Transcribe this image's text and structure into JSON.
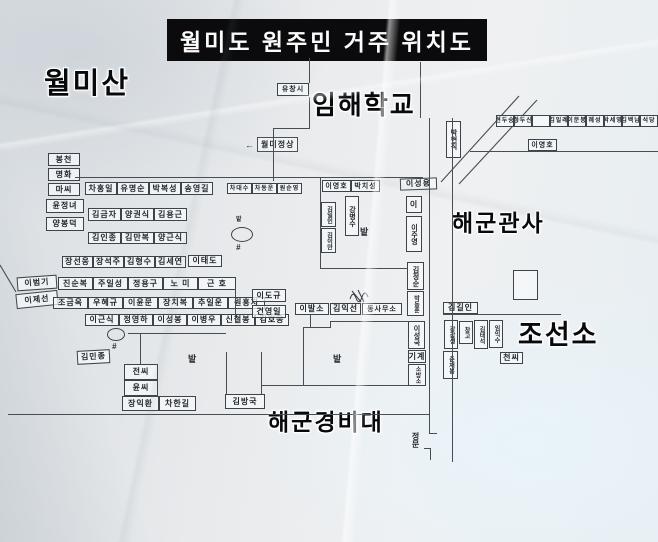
{
  "title": "월미도 원주민 거주 위치도",
  "area_labels": [
    {
      "id": "wolmisan",
      "text": "월미산",
      "x": 44,
      "y": 70,
      "fs": 29
    },
    {
      "id": "imhae-school",
      "text": "임해학교",
      "x": 312,
      "y": 92,
      "fs": 26
    },
    {
      "id": "navy-quarters",
      "text": "해군관사",
      "x": 452,
      "y": 212,
      "fs": 23
    },
    {
      "id": "shipyard",
      "text": "조선소",
      "x": 518,
      "y": 322,
      "fs": 27
    },
    {
      "id": "navy-guard",
      "text": "해군경비대",
      "x": 268,
      "y": 411,
      "fs": 23
    }
  ],
  "summit": {
    "arrow": "←",
    "text": "월미정상"
  },
  "gate": {
    "text": "정문"
  },
  "field_labels": [
    {
      "text": "밭",
      "x": 360,
      "y": 228,
      "fs": 9
    },
    {
      "text": "밭",
      "x": 188,
      "y": 355,
      "fs": 9
    },
    {
      "text": "밭",
      "x": 333,
      "y": 355,
      "fs": 9
    },
    {
      "text": "밭",
      "x": 236,
      "y": 217,
      "fs": 6
    }
  ],
  "houses": [
    {
      "t": "봉천",
      "x": 48,
      "y": 153,
      "w": 32,
      "h": 13
    },
    {
      "t": "명화",
      "x": 48,
      "y": 168,
      "w": 32,
      "h": 13
    },
    {
      "t": "마씨",
      "x": 48,
      "y": 183,
      "w": 32,
      "h": 13
    },
    {
      "t": "윤정녀",
      "x": 46,
      "y": 199,
      "w": 38,
      "h": 14
    },
    {
      "t": "양봉덕",
      "x": 46,
      "y": 217,
      "w": 38,
      "h": 14
    },
    {
      "t": "차홍일",
      "x": 85,
      "y": 182,
      "w": 32,
      "h": 13
    },
    {
      "t": "유명순",
      "x": 117,
      "y": 182,
      "w": 32,
      "h": 13
    },
    {
      "t": "박복성",
      "x": 149,
      "y": 182,
      "w": 32,
      "h": 13
    },
    {
      "t": "송영길",
      "x": 181,
      "y": 182,
      "w": 32,
      "h": 13
    },
    {
      "t": "차대수",
      "x": 227,
      "y": 183,
      "w": 25,
      "h": 11,
      "fs": 6
    },
    {
      "t": "차동운",
      "x": 252,
      "y": 183,
      "w": 25,
      "h": 11,
      "fs": 6
    },
    {
      "t": "원순영",
      "x": 277,
      "y": 183,
      "w": 25,
      "h": 11,
      "fs": 6
    },
    {
      "t": "김금자",
      "x": 88,
      "y": 208,
      "w": 33,
      "h": 13
    },
    {
      "t": "양권식",
      "x": 121,
      "y": 208,
      "w": 33,
      "h": 13
    },
    {
      "t": "김용근",
      "x": 154,
      "y": 208,
      "w": 33,
      "h": 13
    },
    {
      "t": "김인종",
      "x": 88,
      "y": 232,
      "w": 33,
      "h": 12
    },
    {
      "t": "김만복",
      "x": 121,
      "y": 232,
      "w": 33,
      "h": 12
    },
    {
      "t": "양근식",
      "x": 154,
      "y": 232,
      "w": 33,
      "h": 12
    },
    {
      "t": "장선웅",
      "x": 62,
      "y": 256,
      "w": 31,
      "h": 12
    },
    {
      "t": "장석주",
      "x": 93,
      "y": 256,
      "w": 31,
      "h": 12
    },
    {
      "t": "김형수",
      "x": 124,
      "y": 256,
      "w": 31,
      "h": 12
    },
    {
      "t": "김세연",
      "x": 155,
      "y": 256,
      "w": 31,
      "h": 12
    },
    {
      "t": "이태도",
      "x": 188,
      "y": 255,
      "w": 34,
      "h": 12
    },
    {
      "t": "이범기",
      "x": 17,
      "y": 276,
      "w": 40,
      "h": 14,
      "r": -4
    },
    {
      "t": "이제선",
      "x": 16,
      "y": 292,
      "w": 42,
      "h": 15,
      "r": -6
    },
    {
      "t": "진순복",
      "x": 58,
      "y": 277,
      "w": 35,
      "h": 13
    },
    {
      "t": "주일성",
      "x": 93,
      "y": 277,
      "w": 35,
      "h": 13
    },
    {
      "t": "정용구",
      "x": 128,
      "y": 277,
      "w": 35,
      "h": 13
    },
    {
      "t": "노 미",
      "x": 163,
      "y": 277,
      "w": 35,
      "h": 13
    },
    {
      "t": "근 호",
      "x": 198,
      "y": 277,
      "w": 38,
      "h": 13
    },
    {
      "t": "조금옥",
      "x": 53,
      "y": 297,
      "w": 35,
      "h": 12
    },
    {
      "t": "우혜규",
      "x": 88,
      "y": 297,
      "w": 35,
      "h": 12
    },
    {
      "t": "이윤문",
      "x": 123,
      "y": 297,
      "w": 35,
      "h": 12
    },
    {
      "t": "장치복",
      "x": 158,
      "y": 297,
      "w": 35,
      "h": 12
    },
    {
      "t": "추일운",
      "x": 193,
      "y": 297,
      "w": 35,
      "h": 12
    },
    {
      "t": "원홍지",
      "x": 228,
      "y": 297,
      "w": 37,
      "h": 12
    },
    {
      "t": "이근식",
      "x": 85,
      "y": 314,
      "w": 34,
      "h": 12
    },
    {
      "t": "정영하",
      "x": 119,
      "y": 314,
      "w": 34,
      "h": 12
    },
    {
      "t": "이성봉",
      "x": 153,
      "y": 314,
      "w": 34,
      "h": 12
    },
    {
      "t": "이병우",
      "x": 187,
      "y": 314,
      "w": 34,
      "h": 12
    },
    {
      "t": "신철봉",
      "x": 221,
      "y": 314,
      "w": 34,
      "h": 12
    },
    {
      "t": "김호웅",
      "x": 255,
      "y": 314,
      "w": 34,
      "h": 12
    },
    {
      "t": "김민종",
      "x": 77,
      "y": 350,
      "w": 33,
      "h": 14,
      "r": -3
    },
    {
      "t": "전씨",
      "x": 124,
      "y": 364,
      "w": 34,
      "h": 16
    },
    {
      "t": "윤씨",
      "x": 124,
      "y": 380,
      "w": 34,
      "h": 16
    },
    {
      "t": "장익환",
      "x": 122,
      "y": 396,
      "w": 37,
      "h": 15
    },
    {
      "t": "차한길",
      "x": 159,
      "y": 396,
      "w": 37,
      "h": 15
    },
    {
      "t": "김방국",
      "x": 225,
      "y": 394,
      "w": 40,
      "h": 15
    },
    {
      "t": "이도규",
      "x": 252,
      "y": 289,
      "w": 34,
      "h": 13
    },
    {
      "t": "건영일",
      "x": 252,
      "y": 305,
      "w": 34,
      "h": 13
    },
    {
      "t": "이발소",
      "x": 295,
      "y": 303,
      "w": 34,
      "h": 12
    },
    {
      "t": "김익선",
      "x": 330,
      "y": 303,
      "w": 31,
      "h": 12
    },
    {
      "t": "동사무소",
      "x": 362,
      "y": 303,
      "w": 40,
      "h": 12,
      "fs": 7
    },
    {
      "t": "이영호",
      "x": 322,
      "y": 180,
      "w": 29,
      "h": 12,
      "fs": 7
    },
    {
      "t": "박치성",
      "x": 351,
      "y": 180,
      "w": 29,
      "h": 12,
      "fs": 7
    },
    {
      "t": "이성용",
      "x": 400,
      "y": 178,
      "w": 37,
      "h": 12,
      "r": -2
    },
    {
      "t": "강병수",
      "x": 345,
      "y": 196,
      "w": 14,
      "h": 40,
      "v": true,
      "fs": 7
    },
    {
      "t": "김일인",
      "x": 321,
      "y": 202,
      "w": 15,
      "h": 25,
      "v": true,
      "fs": 6
    },
    {
      "t": "김이만",
      "x": 321,
      "y": 228,
      "w": 15,
      "h": 25,
      "v": true,
      "fs": 6
    },
    {
      "t": "이",
      "x": 406,
      "y": 196,
      "w": 16,
      "h": 17
    },
    {
      "t": "이주영",
      "x": 406,
      "y": 216,
      "w": 16,
      "h": 36,
      "v": true,
      "fs": 7
    },
    {
      "t": "김정순",
      "x": 407,
      "y": 262,
      "w": 17,
      "h": 28,
      "v": true,
      "fs": 7
    },
    {
      "t": "박동훈",
      "x": 407,
      "y": 291,
      "w": 17,
      "h": 25,
      "v": true,
      "fs": 6
    },
    {
      "t": "이성국",
      "x": 408,
      "y": 321,
      "w": 17,
      "h": 28,
      "v": true,
      "fs": 7
    },
    {
      "t": "기계",
      "x": 408,
      "y": 350,
      "w": 18,
      "h": 13
    },
    {
      "t": "소방소",
      "x": 408,
      "y": 364,
      "w": 18,
      "h": 22,
      "v": true,
      "fs": 6
    },
    {
      "t": "김길인",
      "x": 443,
      "y": 302,
      "w": 35,
      "h": 12
    },
    {
      "t": "강갑생",
      "x": 444,
      "y": 320,
      "w": 14,
      "h": 29,
      "v": true,
      "fs": 6
    },
    {
      "t": "창고",
      "x": 459,
      "y": 321,
      "w": 14,
      "h": 23,
      "v": true,
      "fs": 6
    },
    {
      "t": "김태석",
      "x": 474,
      "y": 320,
      "w": 14,
      "h": 29,
      "v": true,
      "fs": 6
    },
    {
      "t": "임익수",
      "x": 489,
      "y": 320,
      "w": 14,
      "h": 28,
      "v": true,
      "fs": 6
    },
    {
      "t": "춘재봉",
      "x": 443,
      "y": 351,
      "w": 15,
      "h": 28,
      "v": true,
      "fs": 6
    },
    {
      "t": "천씨",
      "x": 500,
      "y": 352,
      "w": 23,
      "h": 12
    },
    {
      "t": "박현직",
      "x": 446,
      "y": 121,
      "w": 15,
      "h": 37,
      "v": true,
      "fs": 7
    },
    {
      "t": "이영호",
      "x": 528,
      "y": 139,
      "w": 29,
      "h": 12,
      "fs": 7
    },
    {
      "t": "현두숭",
      "x": 496,
      "y": 115,
      "w": 18,
      "h": 12,
      "fs": 6
    },
    {
      "t": "청두신",
      "x": 514,
      "y": 115,
      "w": 18,
      "h": 12,
      "fs": 6
    },
    {
      "t": "",
      "x": 532,
      "y": 115,
      "w": 18,
      "h": 12,
      "fs": 6
    },
    {
      "t": "김일례",
      "x": 550,
      "y": 115,
      "w": 18,
      "h": 12,
      "fs": 6
    },
    {
      "t": "이문봉",
      "x": 568,
      "y": 115,
      "w": 18,
      "h": 12,
      "fs": 6
    },
    {
      "t": "혜성",
      "x": 586,
      "y": 115,
      "w": 18,
      "h": 12,
      "fs": 6
    },
    {
      "t": "박세영",
      "x": 604,
      "y": 115,
      "w": 18,
      "h": 12,
      "fs": 6
    },
    {
      "t": "김백남",
      "x": 622,
      "y": 115,
      "w": 18,
      "h": 12,
      "fs": 6
    },
    {
      "t": "석당",
      "x": 640,
      "y": 115,
      "w": 18,
      "h": 12,
      "fs": 6
    },
    {
      "t": "유창시",
      "x": 277,
      "y": 83,
      "w": 32,
      "h": 13,
      "fs": 7
    },
    {
      "t": "",
      "x": 513,
      "y": 270,
      "w": 25,
      "h": 30
    }
  ],
  "wells": [
    {
      "x": 231,
      "y": 227,
      "rx": 22,
      "ry": 15,
      "hash": "#",
      "hx": 236,
      "hy": 244
    },
    {
      "x": 107,
      "y": 328,
      "rx": 18,
      "ry": 13,
      "hash": "#",
      "hx": 112,
      "hy": 343
    }
  ],
  "roads": [
    {
      "x": 75,
      "y": 177,
      "w": 348,
      "h": 1
    },
    {
      "x": 309,
      "y": 58,
      "w": 1,
      "h": 25
    },
    {
      "x": 309,
      "y": 97,
      "w": 1,
      "h": 31
    },
    {
      "x": 273,
      "y": 128,
      "w": 37,
      "h": 1
    },
    {
      "x": 273,
      "y": 128,
      "w": 1,
      "h": 53
    },
    {
      "x": 420,
      "y": 62,
      "w": 1,
      "h": 56
    },
    {
      "x": 429,
      "y": 118,
      "w": 1,
      "h": 315
    },
    {
      "x": 452,
      "y": 118,
      "w": 1,
      "h": 344
    },
    {
      "x": 429,
      "y": 433,
      "w": 8,
      "h": 1
    },
    {
      "x": 424,
      "y": 448,
      "w": 7,
      "h": 1
    },
    {
      "x": 430,
      "y": 448,
      "w": 1,
      "h": 12
    },
    {
      "x": 8,
      "y": 414,
      "w": 421,
      "h": 1
    },
    {
      "x": 470,
      "y": 151,
      "w": 188,
      "h": 1
    },
    {
      "x": 443,
      "y": 314,
      "w": 118,
      "h": 1
    },
    {
      "x": 320,
      "y": 178,
      "w": 1,
      "h": 90
    },
    {
      "x": 320,
      "y": 268,
      "w": 88,
      "h": 1
    },
    {
      "x": 303,
      "y": 327,
      "w": 1,
      "h": 59
    },
    {
      "x": 303,
      "y": 327,
      "w": 28,
      "h": 1
    },
    {
      "x": 330,
      "y": 321,
      "w": 1,
      "h": 7
    },
    {
      "x": 330,
      "y": 321,
      "w": 79,
      "h": 1
    },
    {
      "x": 226,
      "y": 352,
      "w": 1,
      "h": 42
    },
    {
      "x": 261,
      "y": 352,
      "w": 1,
      "h": 42
    },
    {
      "x": 261,
      "y": 385,
      "w": 148,
      "h": 1
    },
    {
      "x": 128,
      "y": 333,
      "w": 98,
      "h": 1
    },
    {
      "x": 140,
      "y": 333,
      "w": 1,
      "h": 31
    },
    {
      "x": 235,
      "y": 288,
      "w": 1,
      "h": 35
    },
    {
      "x": 310,
      "y": 315,
      "w": 1,
      "h": 12
    }
  ],
  "diagonals": [
    {
      "x1": 441,
      "y1": 182,
      "x2": 519,
      "y2": 96
    },
    {
      "x1": 459,
      "y1": 184,
      "x2": 537,
      "y2": 100
    },
    {
      "x1": 0,
      "y1": 265,
      "x2": 16,
      "y2": 292
    }
  ],
  "scribble": {
    "paths": [
      "M350,299 q3,-9 6,-1 q3,8 6,-1 q3,-8 6,0",
      "M352,291 l9,11",
      "M358,290 l6,12"
    ]
  }
}
